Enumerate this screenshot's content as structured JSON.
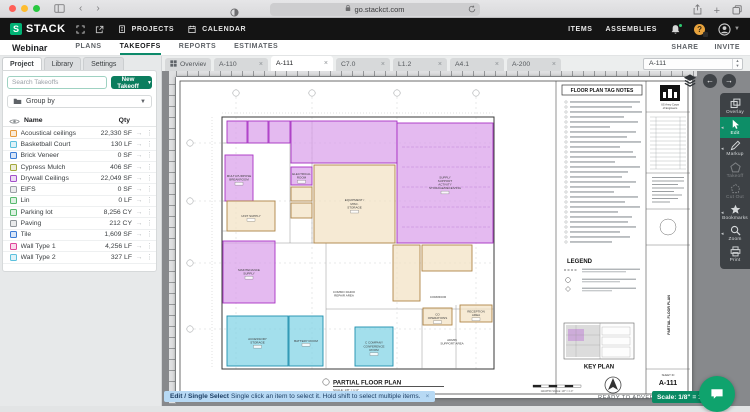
{
  "browser": {
    "url": "go.stackct.com"
  },
  "app_header": {
    "brand": "STACK",
    "projects": "PROJECTS",
    "calendar": "CALENDAR",
    "items": "ITEMS",
    "assemblies": "ASSEMBLIES"
  },
  "subnav": {
    "project_name": "Webinar",
    "tabs": [
      "PLANS",
      "TAKEOFFS",
      "REPORTS",
      "ESTIMATES"
    ],
    "share": "SHARE",
    "invite": "INVITE"
  },
  "left_panel": {
    "tabs": [
      "Project",
      "Library",
      "Settings"
    ],
    "search_placeholder": "Search Takeoffs",
    "new_takeoff": "New Takeoff",
    "group_by": "Group by",
    "name_header": "Name",
    "qty_header": "Qty",
    "rows": [
      {
        "name": "Acoustical ceilings",
        "qty": "22,330 SF",
        "color": "#e59a3c"
      },
      {
        "name": "Basketball Court",
        "qty": "130 LF",
        "color": "#5bc0dd"
      },
      {
        "name": "Brick Veneer",
        "qty": "0 SF",
        "color": "#3a7bd5"
      },
      {
        "name": "Cypress Mulch",
        "qty": "406 SF",
        "color": "#a3a73a"
      },
      {
        "name": "Drywall Ceilings",
        "qty": "22,049 SF",
        "color": "#a24fc9"
      },
      {
        "name": "EIFS",
        "qty": "0 SF",
        "color": "#9aa0a6"
      },
      {
        "name": "Lin",
        "qty": "0 LF",
        "color": "#56b96d"
      },
      {
        "name": "Parking lot",
        "qty": "8,256 CY",
        "color": "#56b96d"
      },
      {
        "name": "Paving",
        "qty": "212 CY",
        "color": "#8f959a"
      },
      {
        "name": "Tile",
        "qty": "1,609 SF",
        "color": "#3a7bd5"
      },
      {
        "name": "Wall Type 1",
        "qty": "4,256 LF",
        "color": "#e0459a"
      },
      {
        "name": "Wall Type 2",
        "qty": "327 LF",
        "color": "#5bc0dd"
      }
    ]
  },
  "doc_tabs": [
    {
      "label": "Overview",
      "overview": true
    },
    {
      "label": "A-110"
    },
    {
      "label": "A-111",
      "active": true
    },
    {
      "label": "C7.0"
    },
    {
      "label": "L1.2"
    },
    {
      "label": "A4.1"
    },
    {
      "label": "A-200"
    }
  ],
  "page_selector": {
    "value": "A-111"
  },
  "toolbar": {
    "tools": [
      {
        "label": "Overlay",
        "icon": "overlay"
      },
      {
        "label": "Edit",
        "icon": "edit",
        "active": true,
        "flyout": true
      },
      {
        "label": "Markup",
        "icon": "markup",
        "flyout": true
      },
      {
        "label": "Takeoff",
        "icon": "takeoff",
        "disabled": true
      },
      {
        "label": "Cut Out",
        "icon": "cutout",
        "disabled": true
      },
      {
        "label": "Bookmarks",
        "icon": "bookmarks",
        "flyout": true
      },
      {
        "label": "Zoom",
        "icon": "zoom",
        "flyout": true
      },
      {
        "label": "Print",
        "icon": "print"
      }
    ]
  },
  "sheet": {
    "tag_notes_title": "FLOOR PLAN TAG NOTES",
    "legend_title": "LEGEND",
    "key_plan_title": "KEY PLAN",
    "plan_title": "PARTIAL FLOOR PLAN",
    "plan_scale": "SCALE: 1/8\" = 1'-0\"",
    "graphic_scale": "GRAPHIC SCALE: 1/8\" = 1'-0\"",
    "agency_line1": "US Army Corps",
    "agency_line2": "of Engineers",
    "sheet_id_label": "SHEET ID",
    "sheet_id": "A-111",
    "rooms": [
      {
        "type": "purple",
        "x": 51,
        "y": 44,
        "w": 20,
        "h": 22,
        "label": ""
      },
      {
        "type": "purple",
        "x": 72,
        "y": 44,
        "w": 20,
        "h": 22,
        "label": ""
      },
      {
        "type": "purple",
        "x": 93,
        "y": 44,
        "w": 21,
        "h": 22,
        "label": ""
      },
      {
        "type": "purple",
        "x": 115,
        "y": 44,
        "w": 106,
        "h": 42,
        "label": ""
      },
      {
        "type": "purple",
        "x": 221,
        "y": 46,
        "w": 96,
        "h": 120,
        "label": "SUPPLY SUPPORT ACTIVITY STORAGE/RECEIVING"
      },
      {
        "type": "purple",
        "x": 49,
        "y": 78,
        "w": 28,
        "h": 46,
        "label": "MULTI-PURPOSE BREAKROOM"
      },
      {
        "type": "purple",
        "x": 47,
        "y": 164,
        "w": 52,
        "h": 62,
        "label": "MAINTENANCE SUPPLY"
      },
      {
        "type": "purple",
        "x": 115,
        "y": 90,
        "w": 21,
        "h": 18,
        "label": "ELECTRICAL ROOM"
      },
      {
        "type": "tan",
        "x": 51,
        "y": 124,
        "w": 48,
        "h": 30,
        "label": "UNIT SUPPLY"
      },
      {
        "type": "tan",
        "x": 138,
        "y": 88,
        "w": 81,
        "h": 78,
        "label": "EQUIPMENT / MISC. STORAGE"
      },
      {
        "type": "tan",
        "x": 115,
        "y": 110,
        "w": 21,
        "h": 14,
        "label": ""
      },
      {
        "type": "tan",
        "x": 115,
        "y": 126,
        "w": 21,
        "h": 15,
        "label": ""
      },
      {
        "type": "tan",
        "x": 217,
        "y": 168,
        "w": 27,
        "h": 56,
        "label": ""
      },
      {
        "type": "tan",
        "x": 246,
        "y": 168,
        "w": 50,
        "h": 26,
        "label": ""
      },
      {
        "type": "tan",
        "x": 247,
        "y": 231,
        "w": 29,
        "h": 17,
        "label": "CO OPERATIONS"
      },
      {
        "type": "tan",
        "x": 284,
        "y": 228,
        "w": 32,
        "h": 17,
        "label": "RECEPTION AREA"
      },
      {
        "type": "blue",
        "x": 51,
        "y": 239,
        "w": 61,
        "h": 50,
        "label": "ACCESSORY STORAGE"
      },
      {
        "type": "blue",
        "x": 113,
        "y": 239,
        "w": 34,
        "h": 50,
        "label": "BATTERY ROOM"
      },
      {
        "type": "blue",
        "x": 179,
        "y": 250,
        "w": 38,
        "h": 39,
        "label": "C COMPANY CONFERENCE ROOM"
      }
    ],
    "annotations": [
      {
        "x": 168,
        "y": 216,
        "label": "COMMO RADIO REPAIR AREA"
      },
      {
        "x": 276,
        "y": 264,
        "label": "ADMIN SUPPORT AREA"
      },
      {
        "x": 262,
        "y": 221,
        "label": "CORRIDOR"
      }
    ]
  },
  "status": {
    "tooltip_bold": "Edit / Single Select",
    "tooltip_text": "Single click an item to select it. Hold shift to select multiple items.",
    "dismiss": "×",
    "ready": "READY TO ADVERTISE",
    "scale_badge": "Scale: 1/8\" = 1'"
  }
}
